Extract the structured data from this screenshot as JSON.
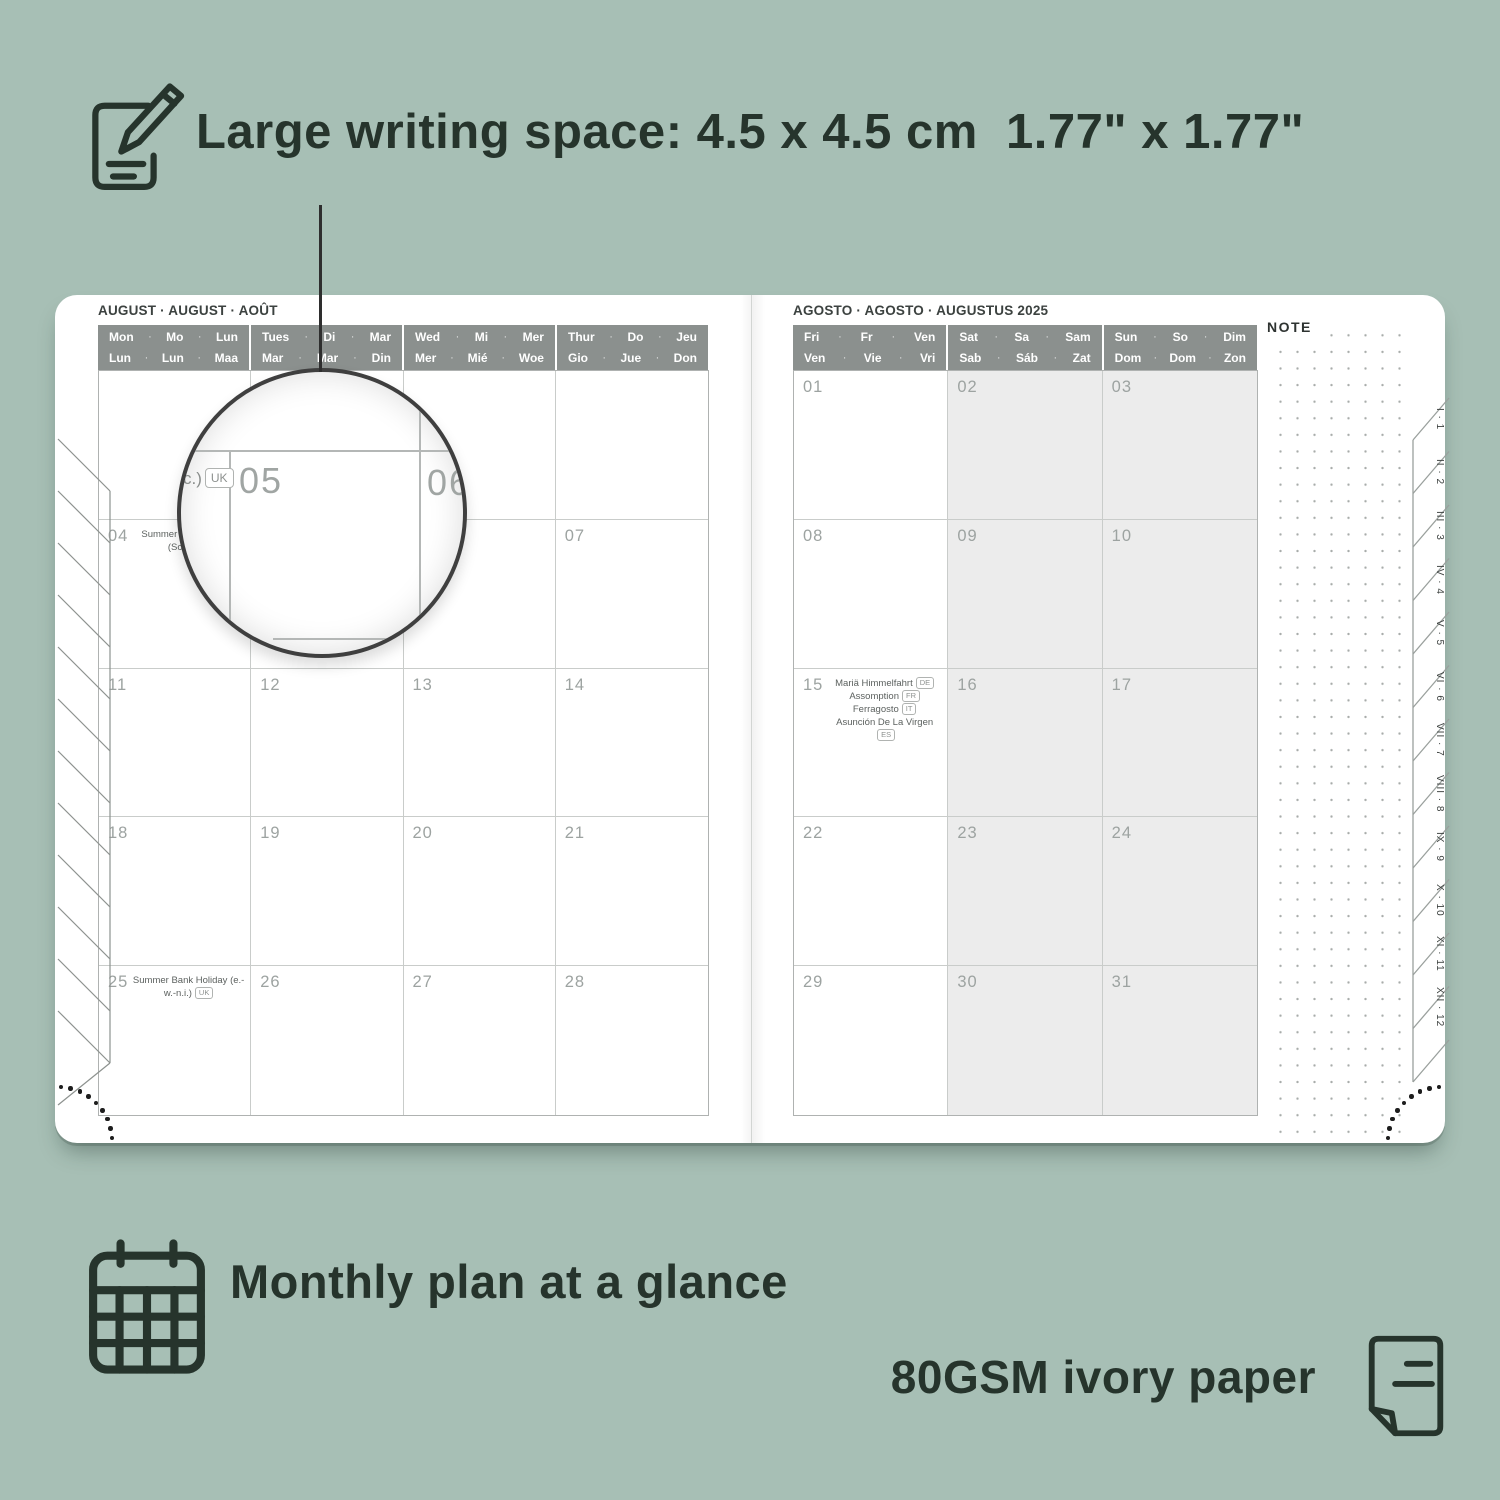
{
  "colors": {
    "background": "#a7bfb5",
    "ink": "#26342c",
    "header_gray": "#8b908e",
    "weekend": "#ececec"
  },
  "annotations": {
    "writing_space": "Large writing space: 4.5 x 4.5 cm  1.77\" x 1.77\"",
    "monthly_plan": "Monthly plan at a glance",
    "paper": "80GSM ivory paper"
  },
  "left_page": {
    "title": "AUGUST · AUGUST · AOÛT",
    "sep": "·",
    "day_headers": [
      {
        "top": [
          "Mon",
          "Mo",
          "Lun"
        ],
        "bottom": [
          "Lun",
          "Lun",
          "Maa"
        ]
      },
      {
        "top": [
          "Tues",
          "Di",
          "Mar"
        ],
        "bottom": [
          "Mar",
          "Mar",
          "Din"
        ]
      },
      {
        "top": [
          "Wed",
          "Mi",
          "Mer"
        ],
        "bottom": [
          "Mer",
          "Mié",
          "Woe"
        ]
      },
      {
        "top": [
          "Thur",
          "Do",
          "Jeu"
        ],
        "bottom": [
          "Gio",
          "Jue",
          "Don"
        ]
      }
    ],
    "weekend_cols": [],
    "weeks": [
      [
        {
          "d": ""
        },
        {
          "d": ""
        },
        {
          "d": ""
        },
        {
          "d": ""
        }
      ],
      [
        {
          "d": "04",
          "h": [
            {
              "t": "Summer Bank Holiday (Sc.)",
              "b": "UK"
            }
          ]
        },
        {
          "d": "05"
        },
        {
          "d": "06"
        },
        {
          "d": "07"
        }
      ],
      [
        {
          "d": "11"
        },
        {
          "d": "12"
        },
        {
          "d": "13"
        },
        {
          "d": "14"
        }
      ],
      [
        {
          "d": "18"
        },
        {
          "d": "19"
        },
        {
          "d": "20"
        },
        {
          "d": "21"
        }
      ],
      [
        {
          "d": "25",
          "h": [
            {
              "t": "Summer Bank Holiday (e.-w.-n.i.)",
              "b": "UK"
            }
          ]
        },
        {
          "d": "26"
        },
        {
          "d": "27"
        },
        {
          "d": "28"
        }
      ]
    ]
  },
  "right_page": {
    "title": "AGOSTO · AGOSTO · AUGUSTUS 2025",
    "sep": "·",
    "day_headers": [
      {
        "top": [
          "Fri",
          "Fr",
          "Ven"
        ],
        "bottom": [
          "Ven",
          "Vie",
          "Vri"
        ]
      },
      {
        "top": [
          "Sat",
          "Sa",
          "Sam"
        ],
        "bottom": [
          "Sab",
          "Sáb",
          "Zat"
        ]
      },
      {
        "top": [
          "Sun",
          "So",
          "Dim"
        ],
        "bottom": [
          "Dom",
          "Dom",
          "Zon"
        ]
      }
    ],
    "weekend_cols": [
      1,
      2
    ],
    "weeks": [
      [
        {
          "d": "01"
        },
        {
          "d": "02"
        },
        {
          "d": "03"
        }
      ],
      [
        {
          "d": "08"
        },
        {
          "d": "09"
        },
        {
          "d": "10"
        }
      ],
      [
        {
          "d": "15",
          "h": [
            {
              "t": "Mariä Himmelfahrt",
              "b": "DE"
            },
            {
              "t": "Assomption",
              "b": "FR"
            },
            {
              "t": "Ferragosto",
              "b": "IT"
            },
            {
              "t": "Asunción De La Virgen",
              "b": "ES"
            }
          ]
        },
        {
          "d": "16"
        },
        {
          "d": "17"
        }
      ],
      [
        {
          "d": "22"
        },
        {
          "d": "23"
        },
        {
          "d": "24"
        }
      ],
      [
        {
          "d": "29"
        },
        {
          "d": "30"
        },
        {
          "d": "31"
        }
      ]
    ],
    "note_label": "NOTE",
    "tabs": [
      "I · 1",
      "II · 2",
      "III · 3",
      "IV · 4",
      "V · 5",
      "VI · 6",
      "VII · 7",
      "VIII · 8",
      "IX · 9",
      "X · 10",
      "XI · 11",
      "XII · 12"
    ]
  },
  "magnifier": {
    "day_a": "05",
    "day_b": "06",
    "fragment": "c.)",
    "fragment_badge": "UK"
  }
}
